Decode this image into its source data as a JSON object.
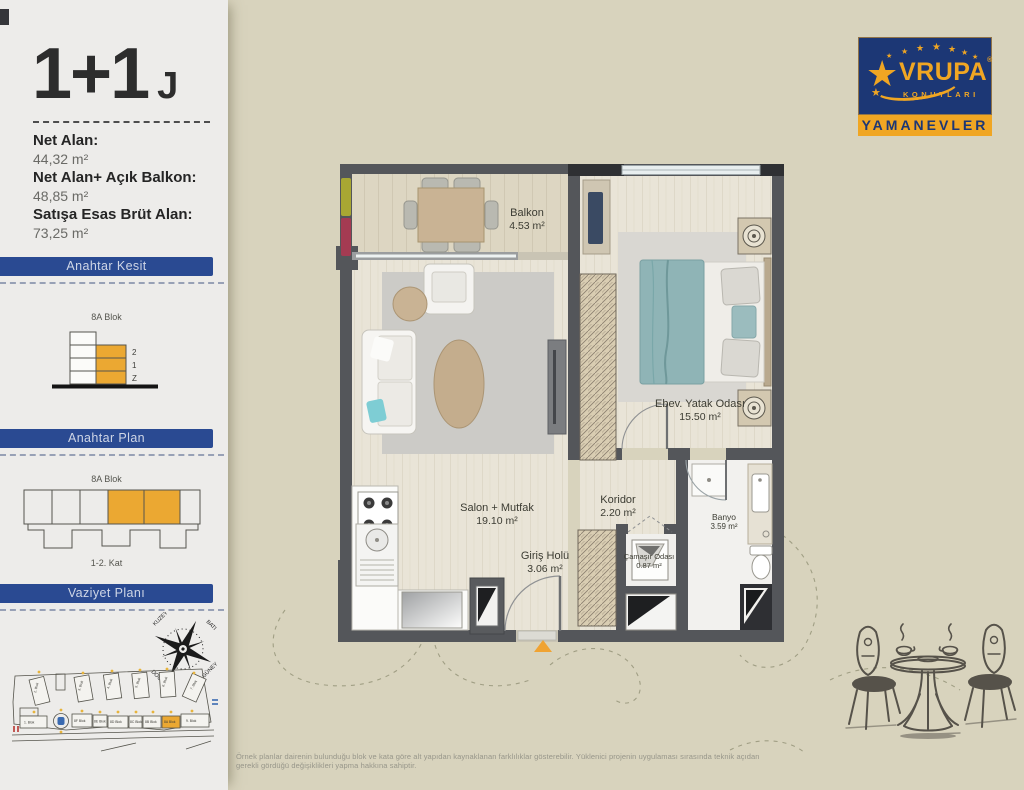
{
  "unit": {
    "type": "1+1",
    "code": "J"
  },
  "areas": [
    {
      "label": "Net Alan:",
      "value": "44,32 m²"
    },
    {
      "label": "Net Alan+ Açık Balkon:",
      "value": "48,85 m²"
    },
    {
      "label": "Satışa Esas Brüt Alan:",
      "value": "73,25 m²"
    }
  ],
  "sections": {
    "kesit": {
      "title": "Anahtar Kesit",
      "block": "8A Blok",
      "floors": [
        "2",
        "1",
        "Z"
      ]
    },
    "plan": {
      "title": "Anahtar Plan",
      "block": "8A Blok",
      "floors": "1-2. Kat"
    },
    "vaziyet": {
      "title": "Vaziyet Planı",
      "compass": {
        "nw": "KUZEY",
        "ne": "BATI",
        "se": "GÜNEY",
        "sw": "DOĞU"
      },
      "blocks": [
        "2. Blok",
        "3. Blok",
        "4. Blok",
        "5. Blok",
        "6. Blok",
        "7. Blok",
        "1. Blok",
        "8F Blok",
        "8E Blok",
        "8D Blok",
        "8C Blok",
        "8B Blok",
        "8A Blok",
        "9. Blok"
      ],
      "highlighted_block": "8A Blok"
    }
  },
  "floor_plan": {
    "rooms": [
      {
        "name": "Balkon",
        "area": "4.53 m²"
      },
      {
        "name": "Ebev. Yatak Odası",
        "area": "15.50 m²"
      },
      {
        "name": "Salon + Mutfak",
        "area": "19.10 m²"
      },
      {
        "name": "Koridor",
        "area": "2.20 m²"
      },
      {
        "name": "Giriş Holü",
        "area": "3.06 m²"
      },
      {
        "name": "Çamaşır Odası",
        "area": "0.87 m²"
      },
      {
        "name": "Banyo",
        "area": "3.59 m²"
      }
    ]
  },
  "logo": {
    "star_char": "★",
    "brand_display": "VRUPA",
    "reg": "®",
    "brand_sub": "KONUTLARI",
    "project": "YAMANEVLER"
  },
  "footer": {
    "disclaimer": "Örnek planlar dairenin bulunduğu blok ve kata göre alt yapıdan kaynaklanan farklılıklar gösterebilir. Yüklenici projenin uygulaması sırasında teknik açıdan gerekli gördüğü değişiklikleri yapma hakkına sahiptir."
  },
  "colors": {
    "accent_orange": "#eba832",
    "banner_blue": "#2a4a92",
    "logo_navy": "#1c3775",
    "logo_gold": "#f0a623",
    "wall_gray": "#54565a",
    "page_beige": "#d8d3bd"
  }
}
